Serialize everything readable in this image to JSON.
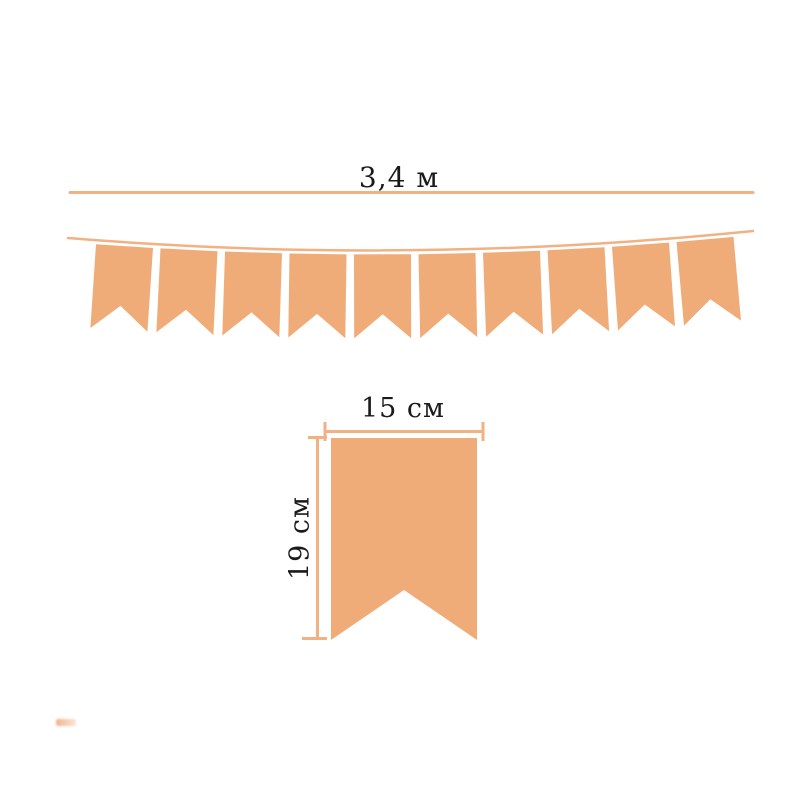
{
  "diagram": {
    "labels": {
      "banner_length": "3,4 м",
      "flag_width": "15 см",
      "flag_height": "19 см"
    },
    "banner": {
      "flag_count": 10
    },
    "colors": {
      "flag_fill": "#EFAC78",
      "line": "#F2B183",
      "text": "#1A1A1A",
      "watermark": "#E5732C"
    }
  }
}
